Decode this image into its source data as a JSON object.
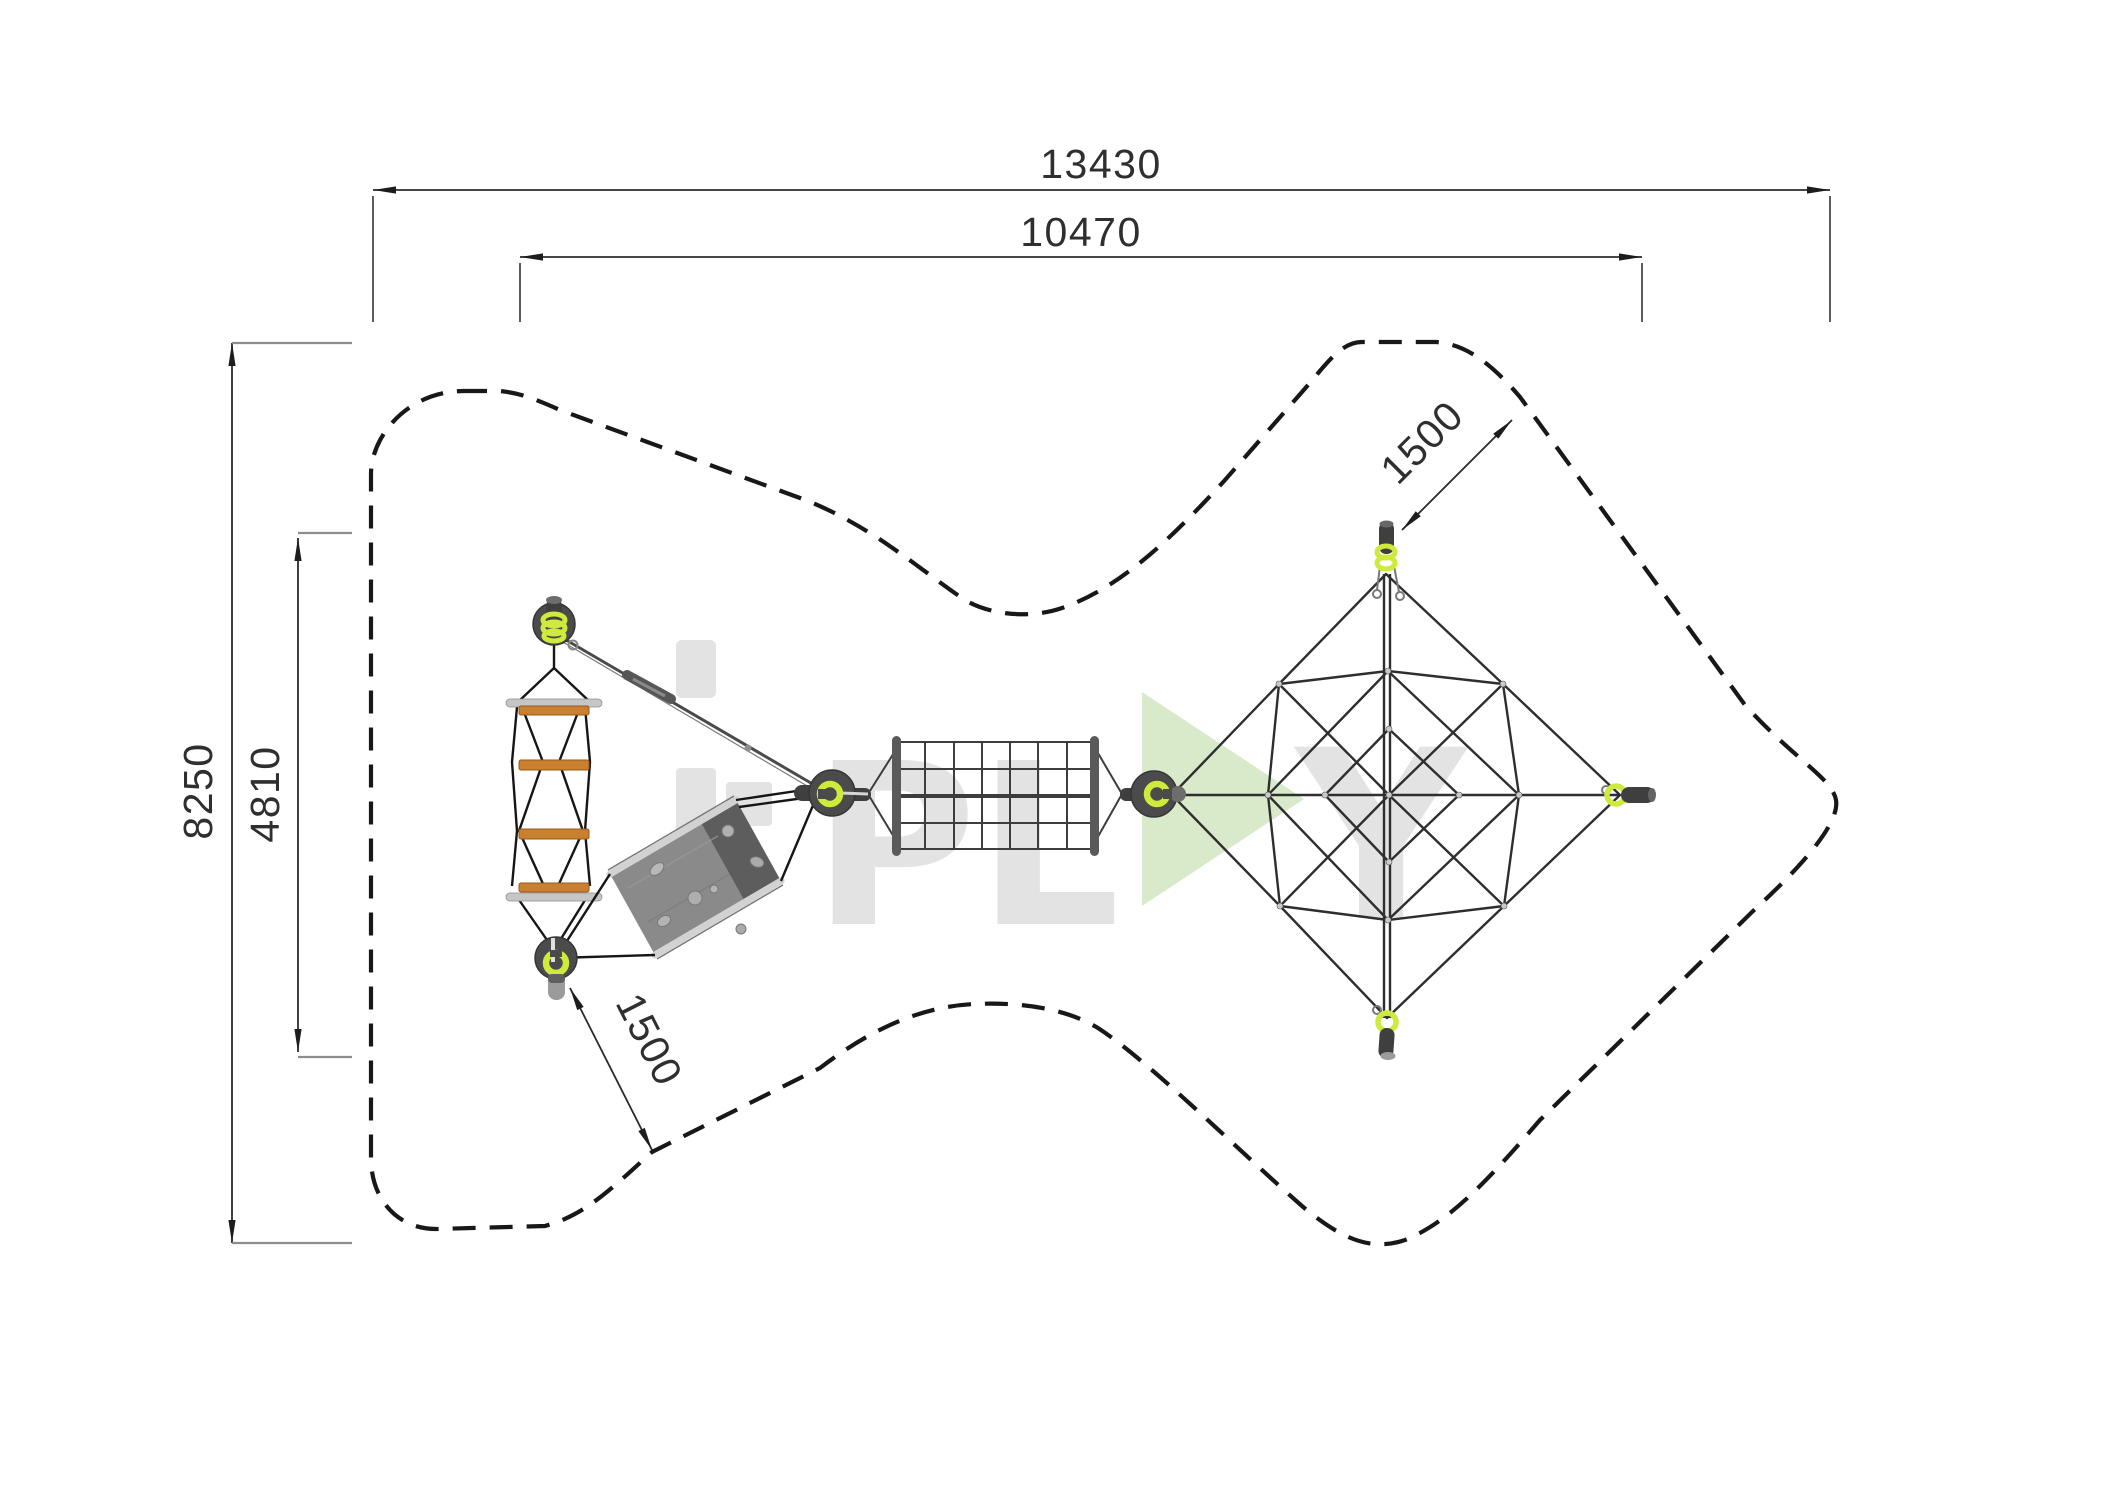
{
  "drawing": {
    "type": "playground-equipment-plan-top-view",
    "dimensions": {
      "total_width": {
        "label": "13430"
      },
      "inner_width": {
        "label": "10470"
      },
      "total_height": {
        "label": "8250"
      },
      "inner_height": {
        "label": "4810"
      },
      "clearance_top_right": {
        "label": "1500"
      },
      "clearance_bottom_left": {
        "label": "1500"
      }
    },
    "watermark": {
      "brand": "i-PLAY",
      "pl_part": "PL",
      "y_part": "Y",
      "letter_color": "#e3e3e3",
      "triangle_color": "#d6e8c5"
    },
    "colors": {
      "outline": "#181818",
      "dimension_text": "#2f2f2f",
      "extension_line": "#8d8d8d",
      "post_disc": "#4b4b4b",
      "post_accent_lime": "#cfe93d",
      "ladder_rung_orange": "#c9802f",
      "ladder_bar_silver": "#c6c6c6",
      "rope_black": "#161616",
      "board_light": "#8a8a8a",
      "board_dark": "#5d5d5d",
      "cable_gray": "#4a4a4a",
      "net_rope": "#2e2e2e"
    }
  }
}
